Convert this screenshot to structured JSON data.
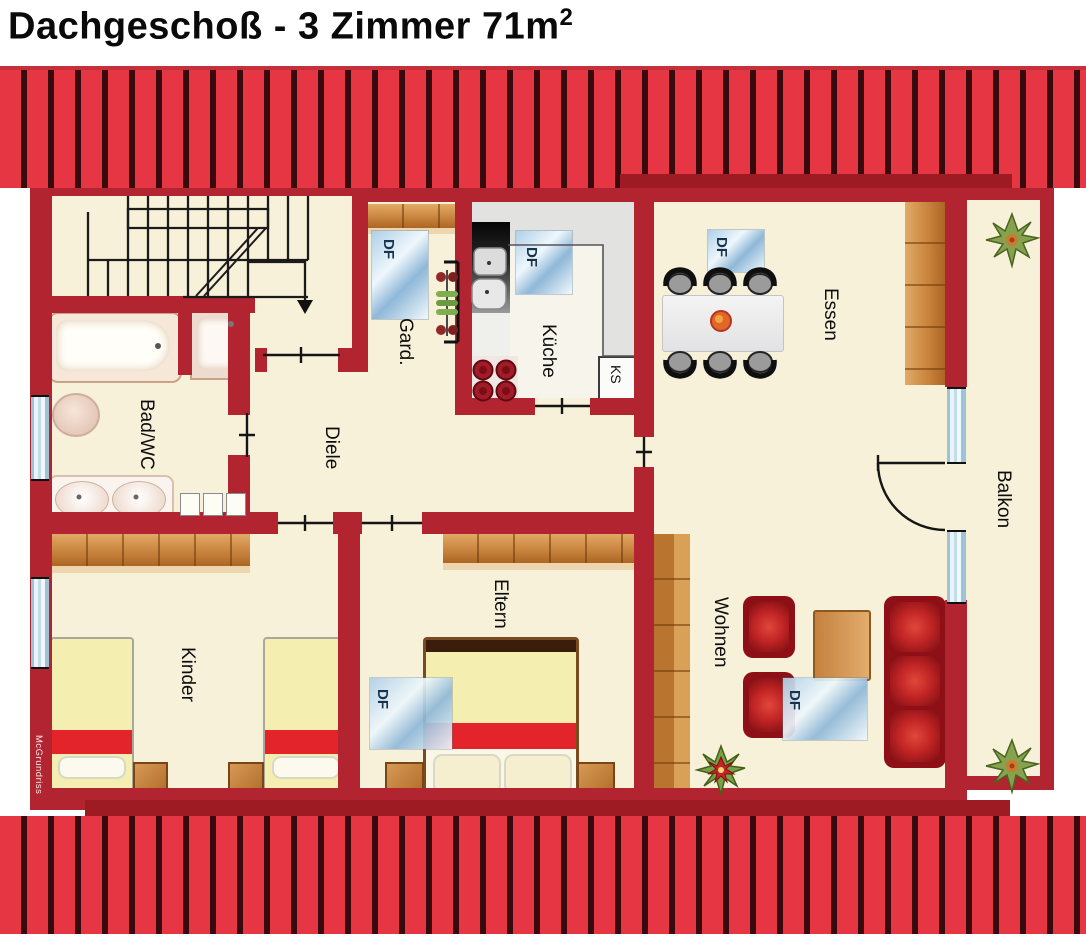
{
  "title": {
    "text": "Dachgeschoß - 3 Zimmer 71m",
    "superscript": "2"
  },
  "watermark": "McGrundriss",
  "room_labels": {
    "bad": "Bad/WC",
    "diele": "Diele",
    "gard": "Gard.",
    "kueche": "Küche",
    "ks": "KS",
    "essen": "Essen",
    "balkon": "Balkon",
    "wohnen": "Wohnen",
    "eltern": "Eltern",
    "kinder": "Kinder"
  },
  "window_label": "DF",
  "colors": {
    "wall_red": "#b2242f",
    "roof_red": "#e73643",
    "roof_dark_stripe": "#380a0e",
    "floor_cream": "#f8f1da",
    "kitchen_gray": "#e2e2e0",
    "wood_brown": "#c5813d",
    "window_blue": "#bcd8e8",
    "furniture_red": "#a01420",
    "bed_yellow": "#f4eeb0",
    "bed_stripe_red": "#e3242b"
  }
}
